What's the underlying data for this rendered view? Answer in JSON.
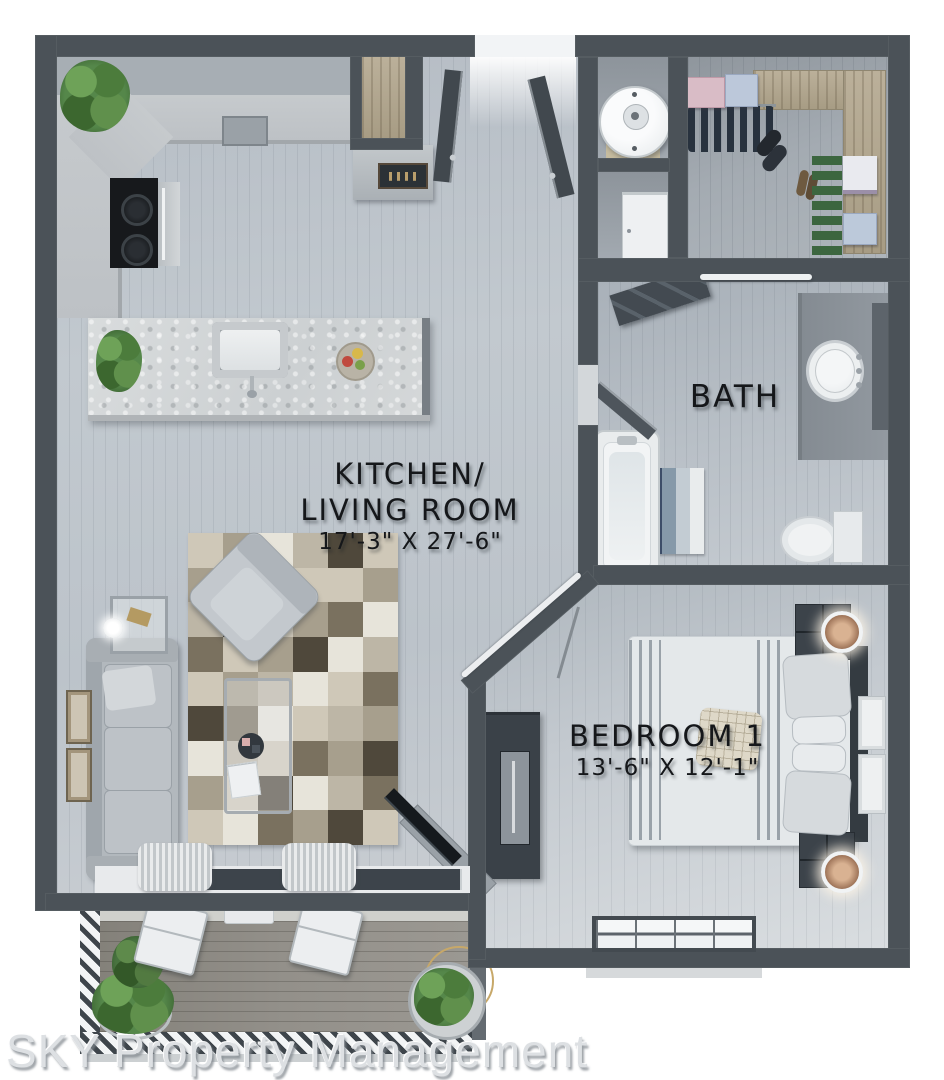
{
  "plan": {
    "rooms": {
      "kitchen_living": {
        "name_line1": "KITCHEN/",
        "name_line2": "LIVING ROOM",
        "dimensions": "17'-3\" X 27'-6\""
      },
      "bath": {
        "name": "BATH"
      },
      "bedroom": {
        "name": "BEDROOM 1",
        "dimensions": "13'-6\" X 12'-1\""
      }
    },
    "watermark": "SKY Property Management",
    "colors": {
      "wall": "#4b5258",
      "floor": "#c2c9cf",
      "balcony_floor": "#93908a",
      "label_text": "#15171a",
      "watermark_text": "#dde0e3"
    }
  }
}
